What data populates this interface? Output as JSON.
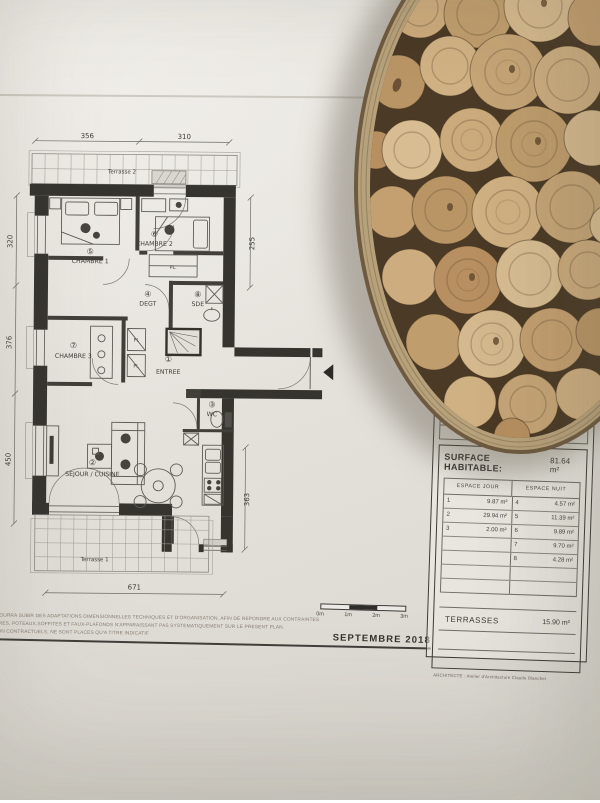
{
  "colors": {
    "paper": "#e9e6e1",
    "ink": "#3c3b37",
    "wood_base": "#4a3a26",
    "wood_rim": "#b7a17b",
    "wood_palette": [
      "#cbaa7c",
      "#bf9d6d",
      "#d5b98e",
      "#c49f70",
      "#b99566",
      "#d0b184",
      "#c6a577",
      "#cdad80",
      "#b78f60",
      "#d8bd92"
    ]
  },
  "plan": {
    "terrace_top": "Terrasse 2",
    "terrace_bottom": "Terrasse 1",
    "rooms": {
      "entree": {
        "num": "①",
        "label": "ENTREE"
      },
      "sejour": {
        "num": "②",
        "label": "SEJOUR / CUISINE"
      },
      "wc": {
        "num": "③",
        "label": "WC"
      },
      "degt": {
        "num": "④",
        "label": "DEGT"
      },
      "chambre1": {
        "num": "⑤",
        "label": "CHAMBRE 1"
      },
      "chambre2": {
        "num": "⑥",
        "label": "CHAMBRE 2"
      },
      "chambre3": {
        "num": "⑦",
        "label": "CHAMBRE 3"
      },
      "sde": {
        "num": "⑧",
        "label": "SDE"
      }
    },
    "closets": {
      "c1": "PL.",
      "c2": "Pl.",
      "c3": "Pl."
    },
    "dims": {
      "top_left": "356",
      "top_right": "310",
      "right_top": "255",
      "left_top": "320",
      "left_mid": "376",
      "left_bottom": "450",
      "right_bottom": "363",
      "bottom": "671"
    }
  },
  "cartouche": {
    "header_fragment": "EMENT",
    "building": "C",
    "floor": "R+1",
    "lot": "3108",
    "surface_title": "SURFACE HABITABLE:",
    "surface_value": "81.64 m²",
    "col_jour": "ESPACE JOUR",
    "col_nuit": "ESPACE NUIT",
    "rows": [
      {
        "jn": "1",
        "jv": "9.87 m²",
        "nn": "4",
        "nv": "4.57 m²"
      },
      {
        "jn": "2",
        "jv": "29.94 m²",
        "nn": "5",
        "nv": "11.39 m²"
      },
      {
        "jn": "3",
        "jv": "2.00 m²",
        "nn": "6",
        "nv": "9.89 m²"
      },
      {
        "jn": "",
        "jv": "",
        "nn": "7",
        "nv": "9.70 m²"
      },
      {
        "jn": "",
        "jv": "",
        "nn": "8",
        "nv": "4.28 m²"
      },
      {
        "jn": "",
        "jv": "",
        "nn": "",
        "nv": ""
      },
      {
        "jn": "",
        "jv": "",
        "nn": "",
        "nv": ""
      }
    ],
    "terrasses_label": "TERRASSES",
    "terrasses_value": "15.90 m²",
    "architect": "ARCHITECTE : Atelier d'Architecture Claude Blanchet"
  },
  "titleblock": {
    "scale": [
      "0m",
      "1m",
      "2m",
      "3m"
    ],
    "date": "SEPTEMBRE 2018"
  },
  "disclaimer": {
    "line1": "ET POURRA SUBIR DES ADAPTATIONS DIMENSIONNELLES TECHNIQUES ET D'ORGANISATION, AFIN DE REPONDRE AUX CONTRAINTES",
    "line2": "OUTRES, POTEAUX,SOFFITES ET FAUX-PLAFONDS N'APPARAISSANT PAS SYSTEMATIQUEMENT SUR LE PRESENT PLAN.",
    "line3": "L, NON CONTRACTUELS, NE SONT PLACES QU'A TITRE INDICATIF"
  }
}
